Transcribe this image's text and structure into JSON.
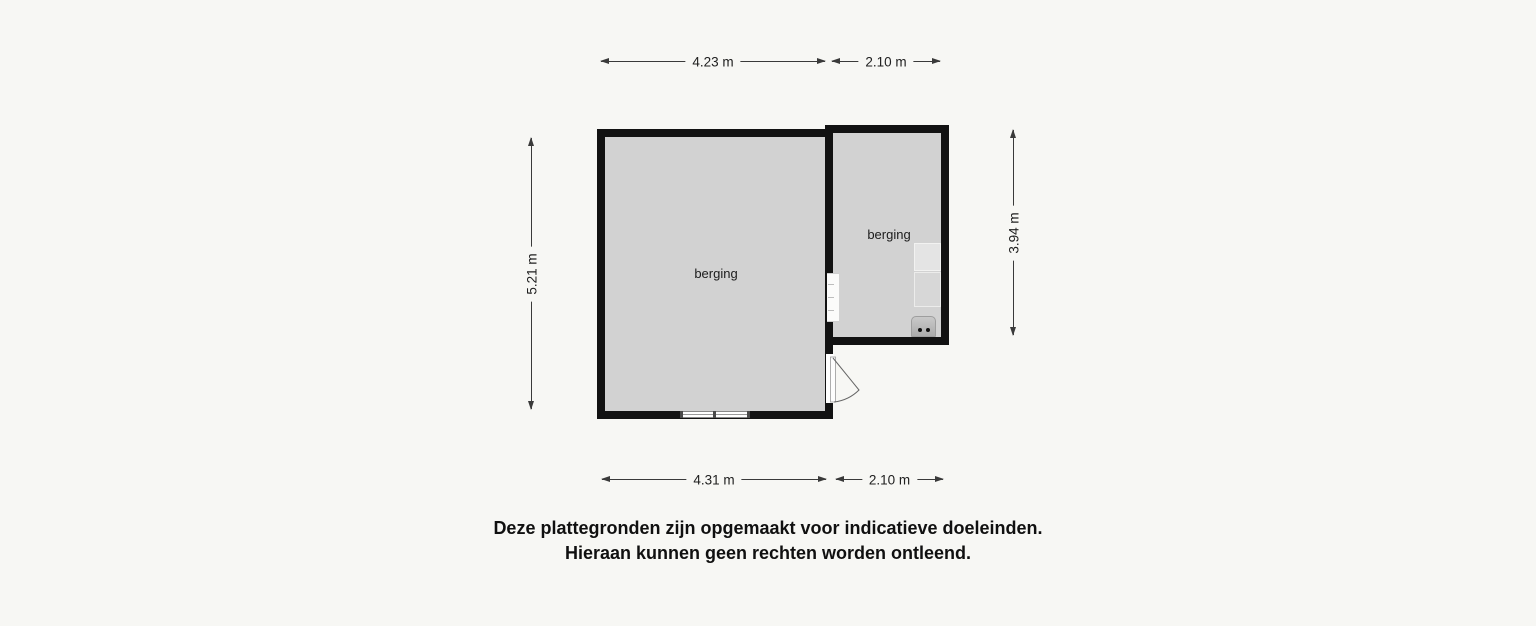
{
  "colors": {
    "page_bg": "#f7f7f4",
    "wall": "#121212",
    "floor": "#d2d2d2",
    "fixture_light": "#e4e4e4",
    "fixture_mid": "#d7d7d7",
    "appliance": "#b9b9b9",
    "dim": "#3a3a3a"
  },
  "floorplan": {
    "rooms": [
      {
        "label": "berging"
      },
      {
        "label": "berging"
      }
    ],
    "symbols": {
      "window": "double-pane window band in bottom wall",
      "interior_door_opening": "white opening in dividing wall",
      "door_swing": "outward swinging door with quarter arc",
      "appliance": "rounded fixture with two dots"
    },
    "dimensions": {
      "top": [
        {
          "label": "4.23 m"
        },
        {
          "label": "2.10 m"
        }
      ],
      "bottom": [
        {
          "label": "4.31 m"
        },
        {
          "label": "2.10 m"
        }
      ],
      "left": {
        "label": "5.21 m"
      },
      "right": {
        "label": "3.94 m"
      }
    }
  },
  "disclaimer": {
    "line1": "Deze plattegronden zijn opgemaakt voor indicatieve doeleinden.",
    "line2": "Hieraan kunnen geen rechten worden ontleend."
  }
}
